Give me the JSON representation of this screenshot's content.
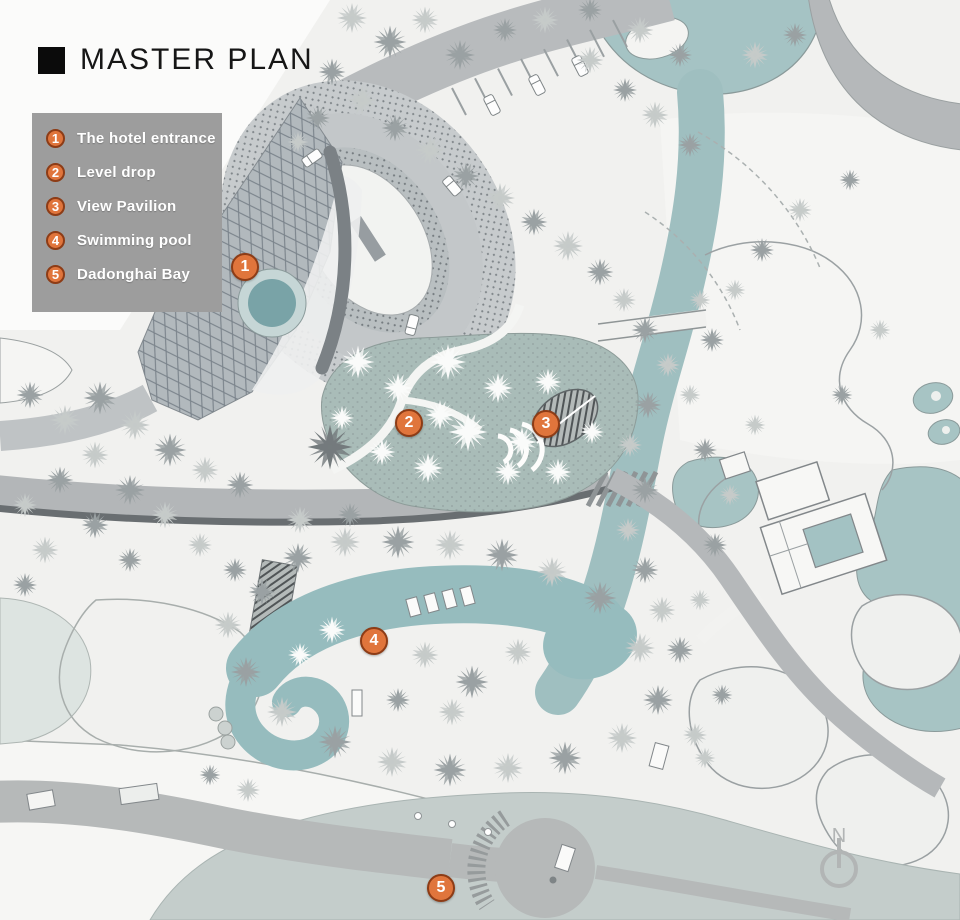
{
  "header": {
    "title": "MASTER PLAN"
  },
  "legend": {
    "items": [
      {
        "number": "1",
        "label": "The hotel entrance"
      },
      {
        "number": "2",
        "label": "Level drop"
      },
      {
        "number": "3",
        "label": "View Pavilion"
      },
      {
        "number": "4",
        "label": "Swimming pool"
      },
      {
        "number": "5",
        "label": "Dadonghai Bay"
      }
    ]
  },
  "map_markers": [
    {
      "number": "1",
      "label": "The hotel entrance"
    },
    {
      "number": "2",
      "label": "Level drop"
    },
    {
      "number": "3",
      "label": "View Pavilion"
    },
    {
      "number": "4",
      "label": "Swimming pool"
    },
    {
      "number": "5",
      "label": "Dadonghai Bay"
    }
  ],
  "compass": {
    "north_label": "N"
  },
  "colors": {
    "marker_orange": "#e0753c",
    "marker_border": "#8d3c16",
    "water_teal": "#9fbfc0",
    "bay_water": "#c4cdcb",
    "legend_background": "#9d9d9d"
  }
}
